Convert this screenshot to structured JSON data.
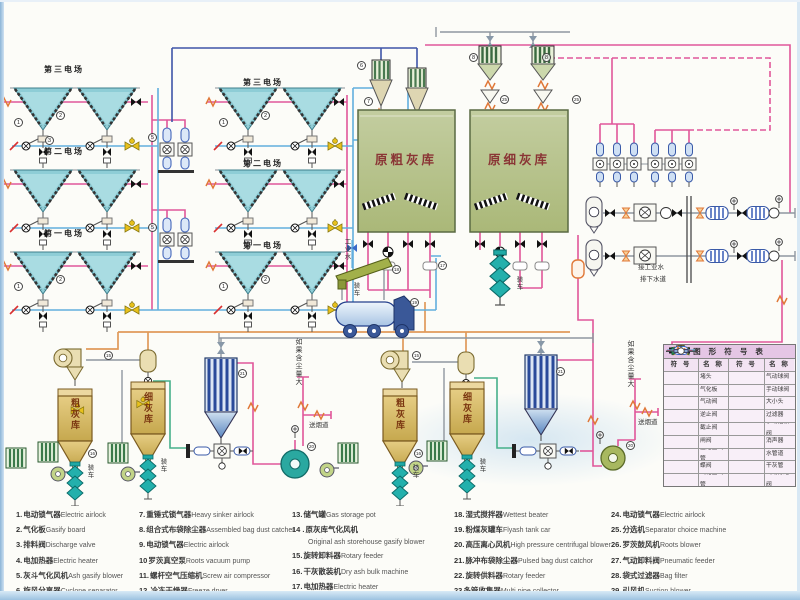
{
  "diagram": {
    "field_labels": [
      "第三电场",
      "第二电场",
      "第一电场"
    ],
    "silo_raw_coarse": "原粗灰库",
    "silo_raw_fine": "原细灰库",
    "silo_coarse": "粗灰库",
    "silo_fine": "细灰库",
    "loading": "装车",
    "industrial_water": "工业水",
    "to_industrial_water": "接工业水",
    "to_sewer": "排下水道",
    "if_dust_large": "如果含尘量大",
    "to_flue": "送烟道",
    "refs": [
      "1",
      "2",
      "3",
      "1",
      "2",
      "1",
      "2",
      "1",
      "2",
      "5",
      "5",
      "6",
      "7",
      "8",
      "8",
      "25",
      "25",
      "15",
      "15",
      "21",
      "21",
      "18",
      "19",
      "20",
      "20",
      "16",
      "16",
      "17"
    ]
  },
  "legend": {
    "col1": [
      {
        "n": "1.",
        "zh": "电动锁气器",
        "en": "Electric airlock"
      },
      {
        "n": "2.",
        "zh": "气化板",
        "en": "Gasify board"
      },
      {
        "n": "3.",
        "zh": "排料阀",
        "en": "Discharge valve"
      },
      {
        "n": "4.",
        "zh": "电加热器",
        "en": "Electric heater"
      },
      {
        "n": "5.",
        "zh": "灰斗气化风机",
        "en": "Ash gasify blower"
      },
      {
        "n": "6.",
        "zh": "旋风分离器",
        "en": "Cyclone separator"
      }
    ],
    "col2": [
      {
        "n": "7.",
        "zh": "重锤式锁气器",
        "en": "Heavy sinker airlock"
      },
      {
        "n": "8.",
        "zh": "组合式布袋除尘器",
        "en": "Assembled bag dust catcher"
      },
      {
        "n": "9.",
        "zh": "电动锁气器",
        "en": "Electric airlock"
      },
      {
        "n": "10",
        "zh": "罗茨真空泵",
        "en": "Roots vacuum pump"
      },
      {
        "n": "11.",
        "zh": "螺杆空气压缩机",
        "en": "Screw air compressor"
      },
      {
        "n": "12.",
        "zh": "冷冻干燥器",
        "en": "Freeze dryer"
      }
    ],
    "col3": [
      {
        "n": "13.",
        "zh": "储气罐",
        "en": "Gas storage pot"
      },
      {
        "n": "14 .",
        "zh": "原灰库气化风机",
        "en": "Original ash storehouse gasify blower"
      },
      {
        "n": "15.",
        "zh": "旋转卸料器",
        "en": "Rotary feeder"
      },
      {
        "n": "16.",
        "zh": "干灰散装机",
        "en": "Dry ash bulk machine"
      },
      {
        "n": "17.",
        "zh": "电加热器",
        "en": "Electric heater"
      }
    ],
    "col4": [
      {
        "n": "18.",
        "zh": "湿式搅拌器",
        "en": "Wettest beater"
      },
      {
        "n": "19.",
        "zh": "粉煤灰罐车",
        "en": "Flyash tank car"
      },
      {
        "n": "20.",
        "zh": "高压离心风机",
        "en": "High pressure centrifugal blower"
      },
      {
        "n": "21.",
        "zh": "脉冲布袋除尘器",
        "en": "Pulsed bag dust catchor"
      },
      {
        "n": "22.",
        "zh": "旋转供料器",
        "en": "Rotary feeder"
      },
      {
        "n": "23",
        "zh": "多管收集器",
        "en": "Multi pipe collector"
      }
    ],
    "col5": [
      {
        "n": "24.",
        "zh": "电动锁气器",
        "en": "Electric airlock"
      },
      {
        "n": "25.",
        "zh": "分选机",
        "en": "Separator choice machine"
      },
      {
        "n": "26.",
        "zh": "罗茨鼓风机",
        "en": "Roots blower"
      },
      {
        "n": "27.",
        "zh": "气动卸料阀",
        "en": "Pneumatic feeder"
      },
      {
        "n": "28.",
        "zh": "袋式过滤器",
        "en": "Bag filter"
      },
      {
        "n": "29.",
        "zh": "引风机",
        "en": "Suction blower"
      }
    ]
  },
  "symbol_table": {
    "title": "图 形 符 号 表",
    "headers": [
      "符 号",
      "名 称",
      "符 号",
      "名 称"
    ],
    "rows": [
      {
        "left": "堵头",
        "right": "气动球阀"
      },
      {
        "left": "气化板",
        "right": "手动球阀"
      },
      {
        "left": "气动阀",
        "right": "大小头"
      },
      {
        "left": "逆止阀",
        "right": "过滤器"
      },
      {
        "left": "截止阀",
        "right": "手动插板阀"
      },
      {
        "left": "闸阀",
        "right": "消声器"
      },
      {
        "left": "压缩空气管",
        "right": "水管道"
      },
      {
        "left": "蝶阀",
        "right": "干灰管"
      },
      {
        "left": "气化空气管",
        "right": "气动分路阀"
      }
    ]
  }
}
